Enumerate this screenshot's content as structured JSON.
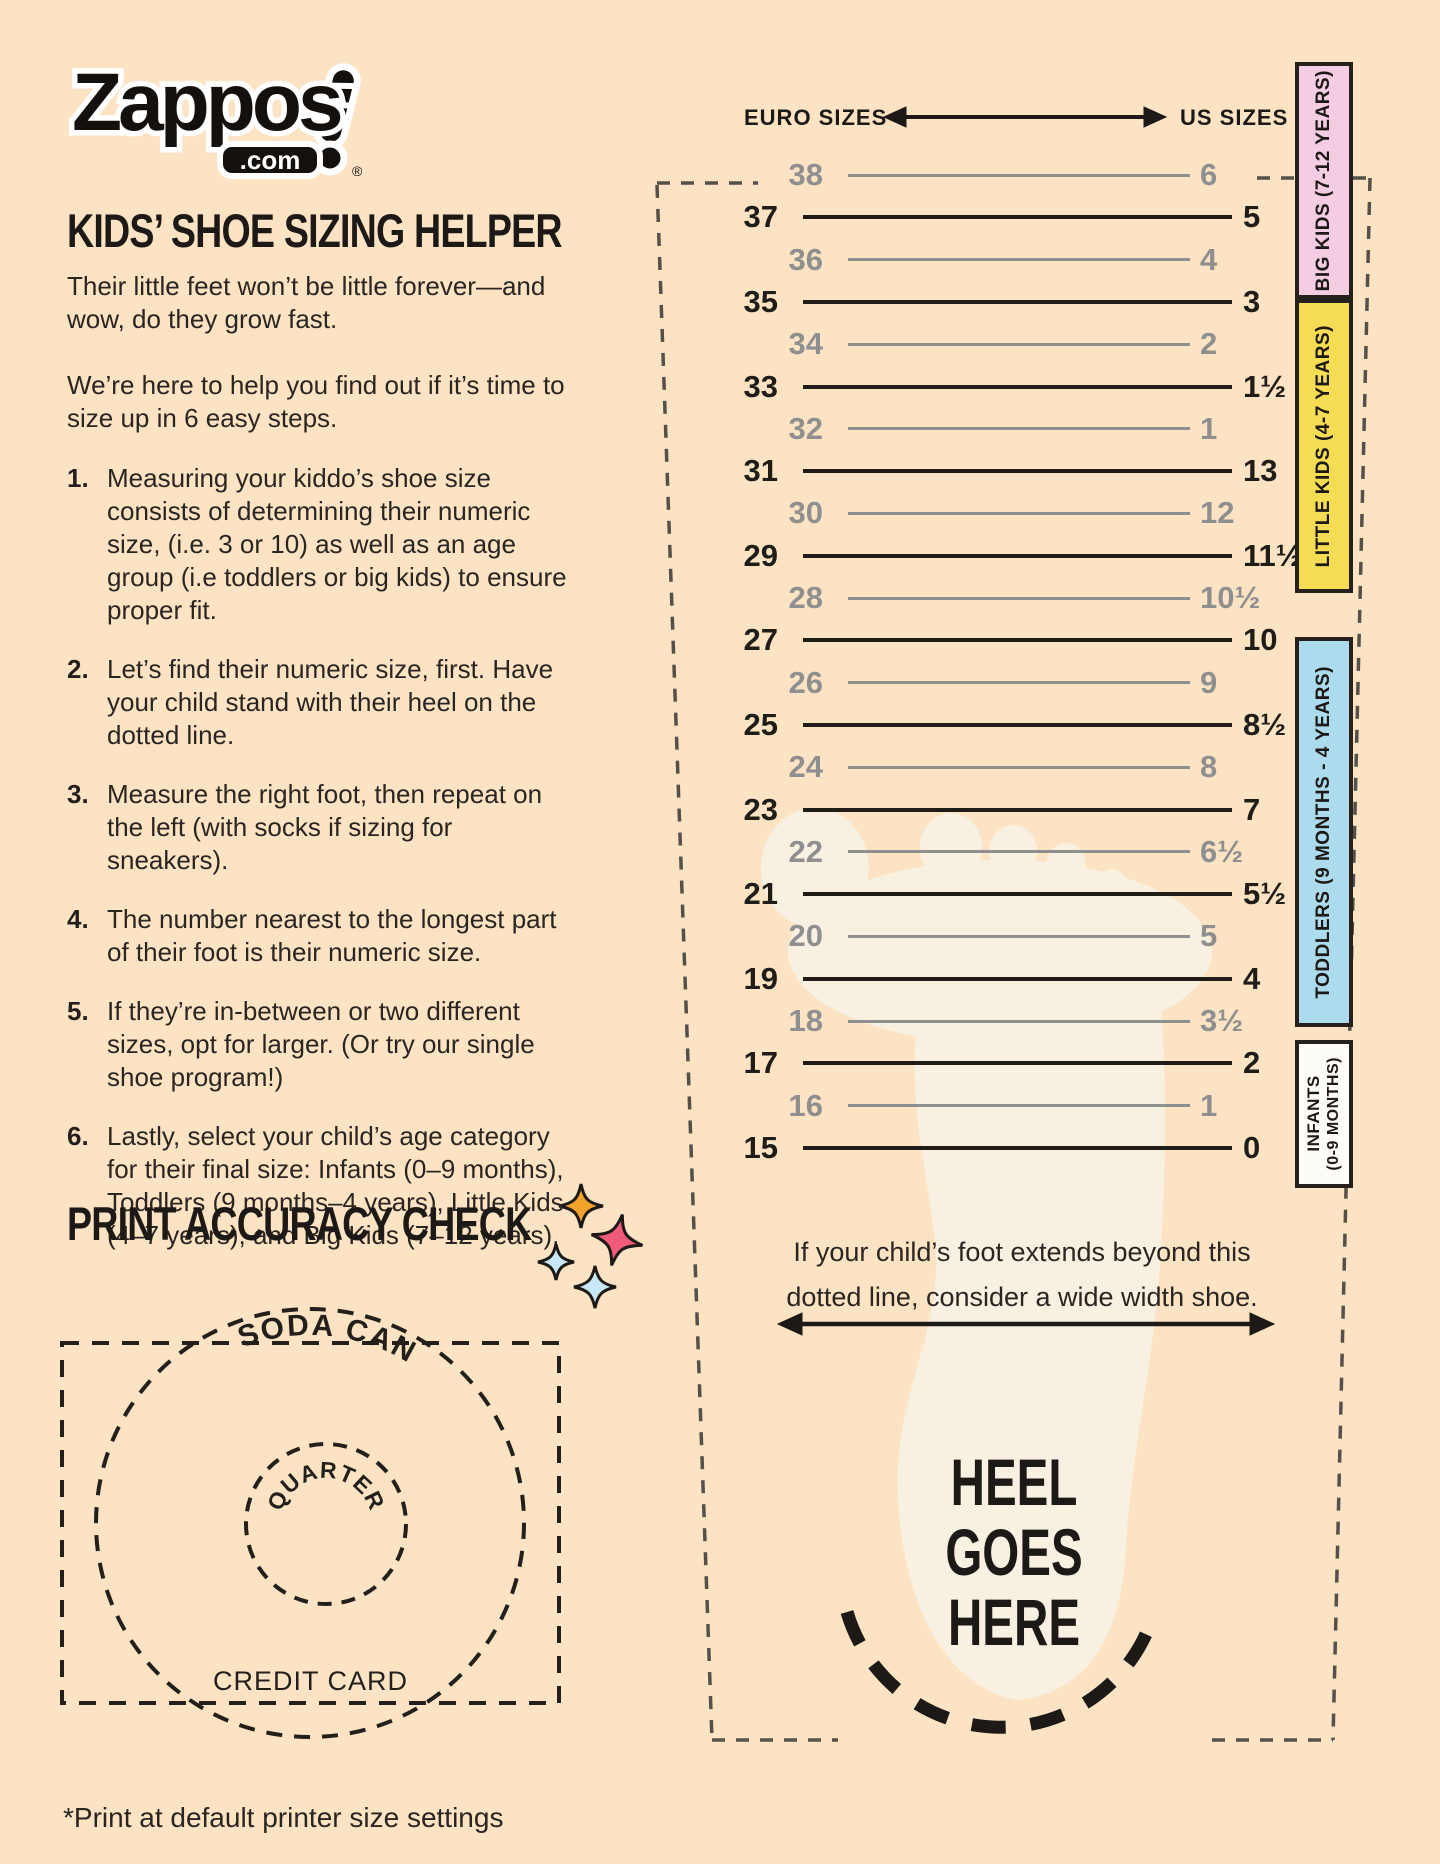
{
  "colors": {
    "background": "#fbe3c3",
    "ink": "#241f1c",
    "gray": "#8f8f8f",
    "band_big_kids": "#f5cde3",
    "band_little_kids": "#f4dc55",
    "band_toddlers": "#abdbec",
    "band_infants": "#fdfcf8",
    "sparkle_orange": "#f2a32c",
    "sparkle_pink": "#ee5a78",
    "sparkle_blue": "#c9e8f7",
    "foot": "#f8f1e1"
  },
  "logo": {
    "brand": "Zappos",
    "tld": ".com",
    "registered": "®"
  },
  "title": "KIDS’ SHOE SIZING HELPER",
  "intro": {
    "p1": "Their little feet won’t be little forever—and wow, do they grow fast.",
    "p2": "We’re here to help you find out if it’s time to size up in 6 easy steps."
  },
  "steps": [
    "Measuring your kiddo’s shoe size consists of determining their numeric size, (i.e. 3 or 10) as well as an age group (i.e toddlers or big kids) to ensure proper fit.",
    "Let’s find their numeric size, first. Have your child stand with their heel on the dotted line.",
    "Measure the right foot, then repeat on the left (with socks if sizing for sneakers).",
    "The number nearest to the longest part of their foot is their numeric size.",
    "If they’re in-between or two different sizes, opt for larger. (Or try our single shoe program!)",
    "Lastly, select your child’s age category for their final size: Infants (0–9 months), Toddlers (9 months–4 years), Little Kids (4–7 years), and Big Kids (7–12 years)."
  ],
  "ruler": {
    "euro_header": "EURO SIZES",
    "us_header": "US SIZES",
    "rows": [
      {
        "euro": "38",
        "us": "6",
        "tone": "gray"
      },
      {
        "euro": "37",
        "us": "5",
        "tone": "black"
      },
      {
        "euro": "36",
        "us": "4",
        "tone": "gray"
      },
      {
        "euro": "35",
        "us": "3",
        "tone": "black"
      },
      {
        "euro": "34",
        "us": "2",
        "tone": "gray"
      },
      {
        "euro": "33",
        "us": "1½",
        "tone": "black"
      },
      {
        "euro": "32",
        "us": "1",
        "tone": "gray"
      },
      {
        "euro": "31",
        "us": "13",
        "tone": "black"
      },
      {
        "euro": "30",
        "us": "12",
        "tone": "gray"
      },
      {
        "euro": "29",
        "us": "11½",
        "tone": "black"
      },
      {
        "euro": "28",
        "us": "10½",
        "tone": "gray"
      },
      {
        "euro": "27",
        "us": "10",
        "tone": "black"
      },
      {
        "euro": "26",
        "us": "9",
        "tone": "gray"
      },
      {
        "euro": "25",
        "us": "8½",
        "tone": "black"
      },
      {
        "euro": "24",
        "us": "8",
        "tone": "gray"
      },
      {
        "euro": "23",
        "us": "7",
        "tone": "black"
      },
      {
        "euro": "22",
        "us": "6½",
        "tone": "gray"
      },
      {
        "euro": "21",
        "us": "5½",
        "tone": "black"
      },
      {
        "euro": "20",
        "us": "5",
        "tone": "gray"
      },
      {
        "euro": "19",
        "us": "4",
        "tone": "black"
      },
      {
        "euro": "18",
        "us": "3½",
        "tone": "gray"
      },
      {
        "euro": "17",
        "us": "2",
        "tone": "black"
      },
      {
        "euro": "16",
        "us": "1",
        "tone": "gray"
      },
      {
        "euro": "15",
        "us": "0",
        "tone": "black"
      }
    ]
  },
  "age_bands": [
    {
      "label": "BIG KIDS (7-12 YEARS)",
      "color": "#f5cde3",
      "top": 62,
      "height": 237
    },
    {
      "label": "LITTLE KIDS (4-7 YEARS)",
      "color": "#f4dc55",
      "top": 299,
      "height": 294
    },
    {
      "label": "TODDLERS (9 MONTHS - 4 YEARS)",
      "color": "#abdbec",
      "top": 637,
      "height": 390
    },
    {
      "label": "INFANTS",
      "label2": "(0-9 MONTHS)",
      "color": "#fdfcf8",
      "top": 1040,
      "height": 148
    }
  ],
  "wide_width_note": {
    "line1": "If your child’s foot extends beyond this",
    "line2": "dotted line, consider a wide width shoe."
  },
  "heel_lines": [
    "HEEL",
    "GOES",
    "HERE"
  ],
  "print_check": {
    "heading": "PRINT ACCURACY CHECK",
    "soda_label": "SODA CAN",
    "quarter_label": "QUARTER",
    "credit_label": "CREDIT CARD"
  },
  "footer": "*Print at default printer size settings"
}
